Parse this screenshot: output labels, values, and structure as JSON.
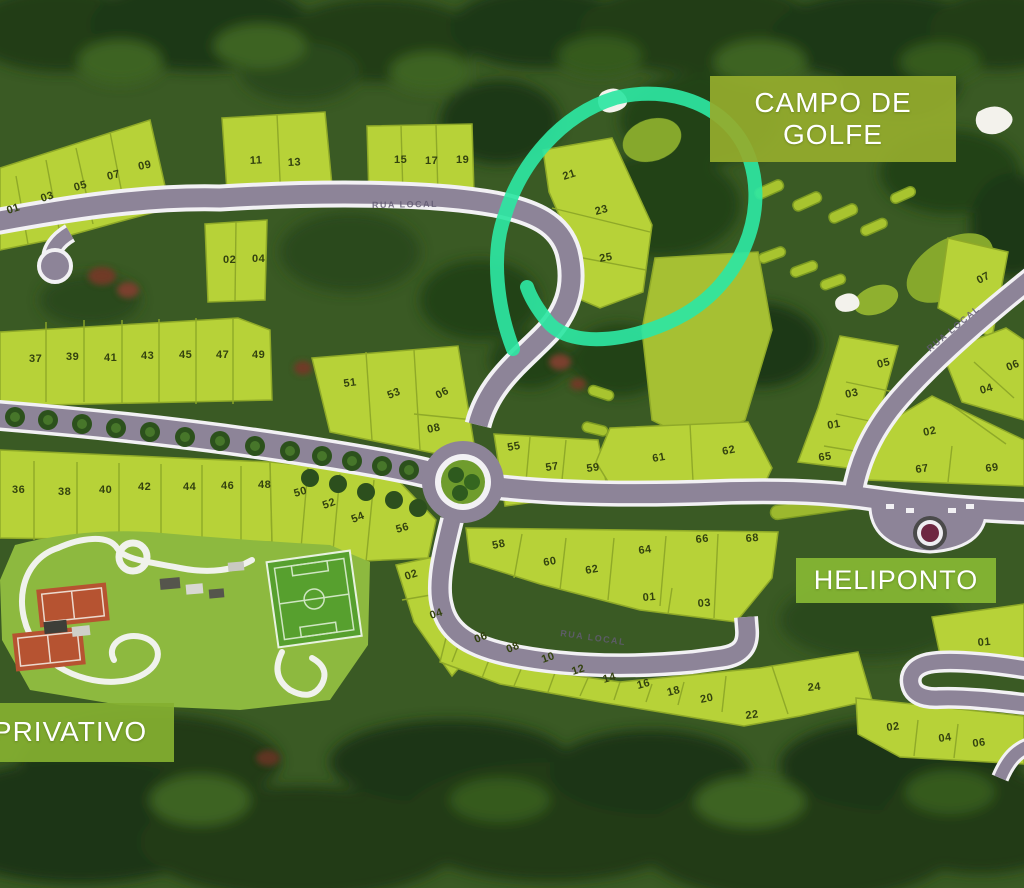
{
  "labels": {
    "golf_course_line1": "CAMPO DE",
    "golf_course_line2": "GOLFE",
    "helipad": "HELIPONTO",
    "private": "PRIVATIVO"
  },
  "roads": {
    "street_name": "RUA LOCAL"
  },
  "colors": {
    "highlight": "#2ee6a2",
    "label_green": "#8fae2f",
    "parcel": "#b7d238",
    "road": "#8d8498"
  },
  "lots": [
    {
      "n": "01",
      "x": 8,
      "y": 214,
      "r": -18
    },
    {
      "n": "03",
      "x": 42,
      "y": 202,
      "r": -18
    },
    {
      "n": "05",
      "x": 75,
      "y": 191,
      "r": -16
    },
    {
      "n": "07",
      "x": 108,
      "y": 180,
      "r": -14
    },
    {
      "n": "09",
      "x": 139,
      "y": 170,
      "r": -12
    },
    {
      "n": "11",
      "x": 250,
      "y": 164,
      "r": -3
    },
    {
      "n": "13",
      "x": 288,
      "y": 166,
      "r": -3
    },
    {
      "n": "02",
      "x": 223,
      "y": 263,
      "r": 0
    },
    {
      "n": "04",
      "x": 252,
      "y": 262,
      "r": 0
    },
    {
      "n": "15",
      "x": 394,
      "y": 163,
      "r": 0
    },
    {
      "n": "17",
      "x": 425,
      "y": 164,
      "r": 0
    },
    {
      "n": "19",
      "x": 456,
      "y": 163,
      "r": 0
    },
    {
      "n": "21",
      "x": 564,
      "y": 180,
      "r": -18
    },
    {
      "n": "23",
      "x": 596,
      "y": 215,
      "r": -15
    },
    {
      "n": "25",
      "x": 600,
      "y": 262,
      "r": -10
    },
    {
      "n": "07",
      "x": 979,
      "y": 284,
      "r": -28
    },
    {
      "n": "37",
      "x": 29,
      "y": 362,
      "r": 0
    },
    {
      "n": "39",
      "x": 66,
      "y": 360,
      "r": 0
    },
    {
      "n": "41",
      "x": 104,
      "y": 361,
      "r": 0
    },
    {
      "n": "43",
      "x": 141,
      "y": 359,
      "r": 0
    },
    {
      "n": "45",
      "x": 179,
      "y": 358,
      "r": 0
    },
    {
      "n": "47",
      "x": 216,
      "y": 358,
      "r": 0
    },
    {
      "n": "49",
      "x": 252,
      "y": 358,
      "r": 0
    },
    {
      "n": "51",
      "x": 344,
      "y": 387,
      "r": -8
    },
    {
      "n": "53",
      "x": 389,
      "y": 399,
      "r": -22
    },
    {
      "n": "06",
      "x": 438,
      "y": 399,
      "r": -28
    },
    {
      "n": "08",
      "x": 428,
      "y": 433,
      "r": -12
    },
    {
      "n": "36",
      "x": 12,
      "y": 493,
      "r": 0
    },
    {
      "n": "38",
      "x": 58,
      "y": 495,
      "r": 0
    },
    {
      "n": "40",
      "x": 99,
      "y": 493,
      "r": 0
    },
    {
      "n": "42",
      "x": 138,
      "y": 490,
      "r": 0
    },
    {
      "n": "44",
      "x": 183,
      "y": 490,
      "r": 0
    },
    {
      "n": "46",
      "x": 221,
      "y": 489,
      "r": 0
    },
    {
      "n": "48",
      "x": 258,
      "y": 488,
      "r": 0
    },
    {
      "n": "50",
      "x": 295,
      "y": 497,
      "r": -16
    },
    {
      "n": "52",
      "x": 324,
      "y": 509,
      "r": -20
    },
    {
      "n": "54",
      "x": 353,
      "y": 523,
      "r": -22
    },
    {
      "n": "56",
      "x": 397,
      "y": 533,
      "r": -16
    },
    {
      "n": "02",
      "x": 406,
      "y": 580,
      "r": -18
    },
    {
      "n": "04",
      "x": 431,
      "y": 619,
      "r": -18
    },
    {
      "n": "55",
      "x": 508,
      "y": 451,
      "r": -10
    },
    {
      "n": "57",
      "x": 546,
      "y": 471,
      "r": -8
    },
    {
      "n": "59",
      "x": 587,
      "y": 472,
      "r": -8
    },
    {
      "n": "61",
      "x": 653,
      "y": 462,
      "r": -10
    },
    {
      "n": "62",
      "x": 723,
      "y": 455,
      "r": -12
    },
    {
      "n": "58",
      "x": 493,
      "y": 549,
      "r": -12
    },
    {
      "n": "60",
      "x": 544,
      "y": 566,
      "r": -10
    },
    {
      "n": "62",
      "x": 586,
      "y": 574,
      "r": -10
    },
    {
      "n": "64",
      "x": 639,
      "y": 554,
      "r": -8
    },
    {
      "n": "66",
      "x": 696,
      "y": 543,
      "r": -6
    },
    {
      "n": "68",
      "x": 746,
      "y": 542,
      "r": -5
    },
    {
      "n": "01",
      "x": 643,
      "y": 601,
      "r": -5
    },
    {
      "n": "03",
      "x": 698,
      "y": 607,
      "r": -5
    },
    {
      "n": "06",
      "x": 476,
      "y": 643,
      "r": -22
    },
    {
      "n": "08",
      "x": 508,
      "y": 653,
      "r": -22
    },
    {
      "n": "10",
      "x": 543,
      "y": 663,
      "r": -20
    },
    {
      "n": "12",
      "x": 573,
      "y": 675,
      "r": -18
    },
    {
      "n": "14",
      "x": 604,
      "y": 683,
      "r": -16
    },
    {
      "n": "16",
      "x": 638,
      "y": 689,
      "r": -15
    },
    {
      "n": "18",
      "x": 668,
      "y": 696,
      "r": -14
    },
    {
      "n": "20",
      "x": 701,
      "y": 703,
      "r": -12
    },
    {
      "n": "22",
      "x": 746,
      "y": 719,
      "r": -8
    },
    {
      "n": "24",
      "x": 808,
      "y": 691,
      "r": -5
    },
    {
      "n": "02",
      "x": 887,
      "y": 731,
      "r": -8
    },
    {
      "n": "04",
      "x": 939,
      "y": 742,
      "r": -8
    },
    {
      "n": "06",
      "x": 973,
      "y": 747,
      "r": -8
    },
    {
      "n": "01",
      "x": 978,
      "y": 646,
      "r": -5
    },
    {
      "n": "65",
      "x": 819,
      "y": 461,
      "r": -8
    },
    {
      "n": "67",
      "x": 916,
      "y": 473,
      "r": -8
    },
    {
      "n": "69",
      "x": 986,
      "y": 472,
      "r": -8
    },
    {
      "n": "01",
      "x": 828,
      "y": 429,
      "r": -10
    },
    {
      "n": "03",
      "x": 846,
      "y": 398,
      "r": -12
    },
    {
      "n": "05",
      "x": 878,
      "y": 368,
      "r": -14
    },
    {
      "n": "02",
      "x": 924,
      "y": 436,
      "r": -12
    },
    {
      "n": "04",
      "x": 981,
      "y": 394,
      "r": -16
    },
    {
      "n": "06",
      "x": 1008,
      "y": 371,
      "r": -22
    }
  ]
}
